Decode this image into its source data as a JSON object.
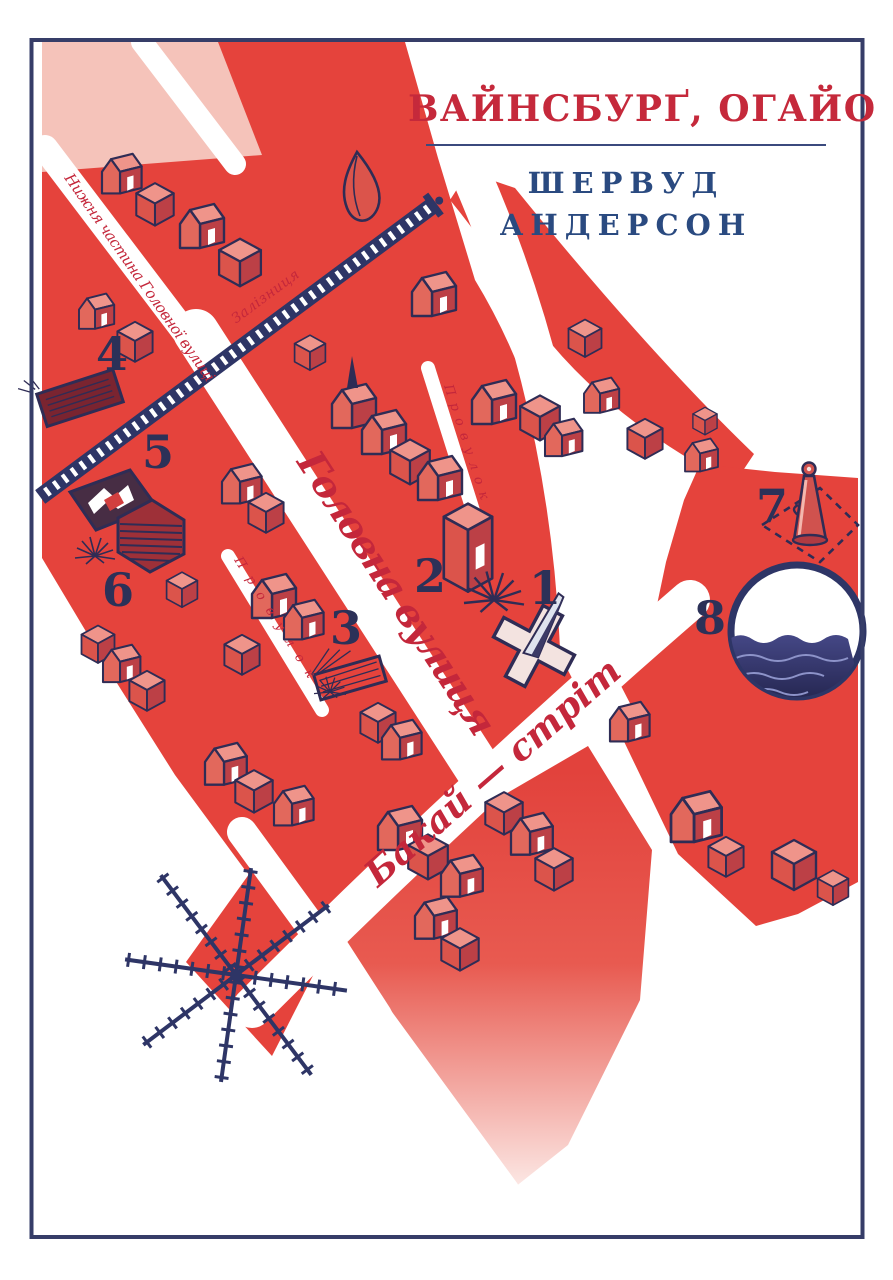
{
  "cover": {
    "title": "Вайнсбурґ, Огайо",
    "author_first": "Шервуд",
    "author_last": "Андерсон"
  },
  "map": {
    "street_labels": {
      "lower_main": "Нижня частина Головної вулиці",
      "railroad": "Залізниця",
      "main_street": "Головна вулиця",
      "alley_upper": "Провулок",
      "alley_lower": "Провулок",
      "buckeye": "Бакай — стріт"
    },
    "markers": [
      "1",
      "2",
      "3",
      "4",
      "5",
      "6",
      "7",
      "8"
    ]
  },
  "colors": {
    "title_red": "#c5293b",
    "author_navy": "#2a4a80",
    "map_red": "#e5433c",
    "outline_navy": "#2f2c55",
    "frame_navy": "#363d68",
    "water_navy": "#3d3f7d"
  }
}
